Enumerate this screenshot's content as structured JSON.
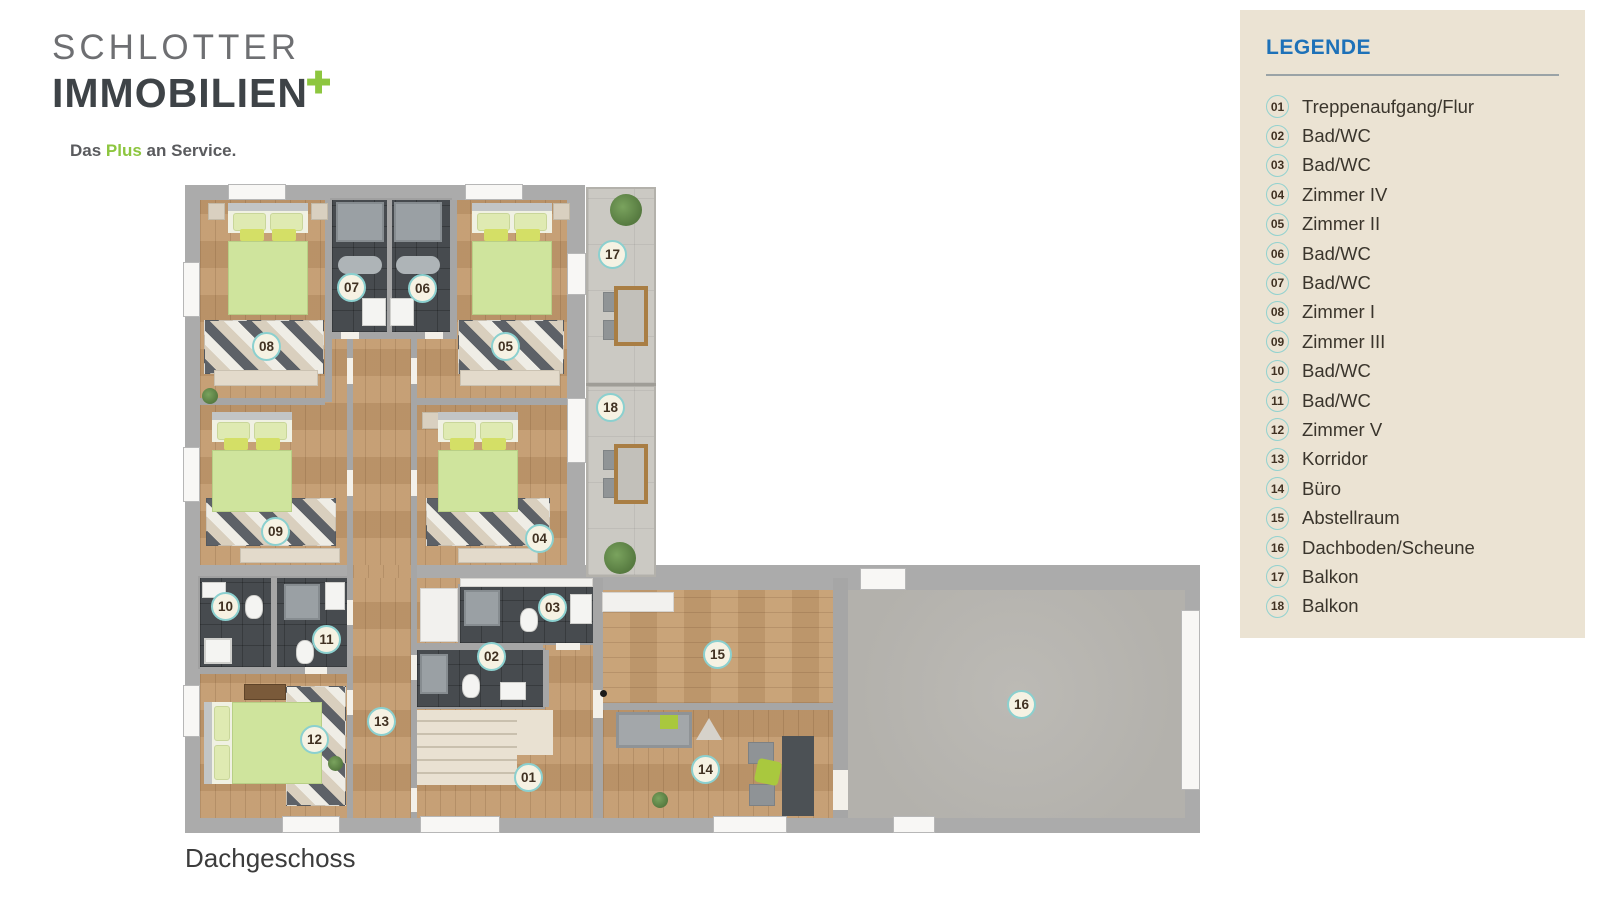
{
  "brand": {
    "line1": "SCHLOTTER",
    "line2": "IMMOBILIEN",
    "plus": "✚",
    "tagline_pre": "Das ",
    "tagline_highlight": "Plus",
    "tagline_post": " an Service."
  },
  "legend": {
    "title": "LEGENDE",
    "items": [
      {
        "num": "01",
        "label": "Treppenaufgang/Flur"
      },
      {
        "num": "02",
        "label": "Bad/WC"
      },
      {
        "num": "03",
        "label": "Bad/WC"
      },
      {
        "num": "04",
        "label": "Zimmer IV"
      },
      {
        "num": "05",
        "label": "Zimmer II"
      },
      {
        "num": "06",
        "label": "Bad/WC"
      },
      {
        "num": "07",
        "label": "Bad/WC"
      },
      {
        "num": "08",
        "label": "Zimmer I"
      },
      {
        "num": "09",
        "label": "Zimmer III"
      },
      {
        "num": "10",
        "label": "Bad/WC"
      },
      {
        "num": "11",
        "label": "Bad/WC"
      },
      {
        "num": "12",
        "label": "Zimmer V"
      },
      {
        "num": "13",
        "label": "Korridor"
      },
      {
        "num": "14",
        "label": "Büro"
      },
      {
        "num": "15",
        "label": "Abstellraum"
      },
      {
        "num": "16",
        "label": "Dachboden/Scheune"
      },
      {
        "num": "17",
        "label": "Balkon"
      },
      {
        "num": "18",
        "label": "Balkon"
      }
    ]
  },
  "plan": {
    "caption": "Dachgeschoss",
    "markers": [
      {
        "num": "01",
        "x": 529,
        "y": 778
      },
      {
        "num": "02",
        "x": 492,
        "y": 657
      },
      {
        "num": "03",
        "x": 553,
        "y": 608
      },
      {
        "num": "04",
        "x": 540,
        "y": 539
      },
      {
        "num": "05",
        "x": 506,
        "y": 347
      },
      {
        "num": "06",
        "x": 423,
        "y": 289
      },
      {
        "num": "07",
        "x": 352,
        "y": 288
      },
      {
        "num": "08",
        "x": 267,
        "y": 347
      },
      {
        "num": "09",
        "x": 276,
        "y": 532
      },
      {
        "num": "10",
        "x": 226,
        "y": 607
      },
      {
        "num": "11",
        "x": 327,
        "y": 640
      },
      {
        "num": "12",
        "x": 315,
        "y": 740
      },
      {
        "num": "13",
        "x": 382,
        "y": 722
      },
      {
        "num": "14",
        "x": 706,
        "y": 770
      },
      {
        "num": "15",
        "x": 718,
        "y": 655
      },
      {
        "num": "16",
        "x": 1022,
        "y": 705
      },
      {
        "num": "17",
        "x": 613,
        "y": 255
      },
      {
        "num": "18",
        "x": 611,
        "y": 408
      }
    ]
  },
  "colors": {
    "brand_green": "#8dc63f",
    "legend_blue": "#1d71b8",
    "marker_teal": "#8bd0cf"
  }
}
